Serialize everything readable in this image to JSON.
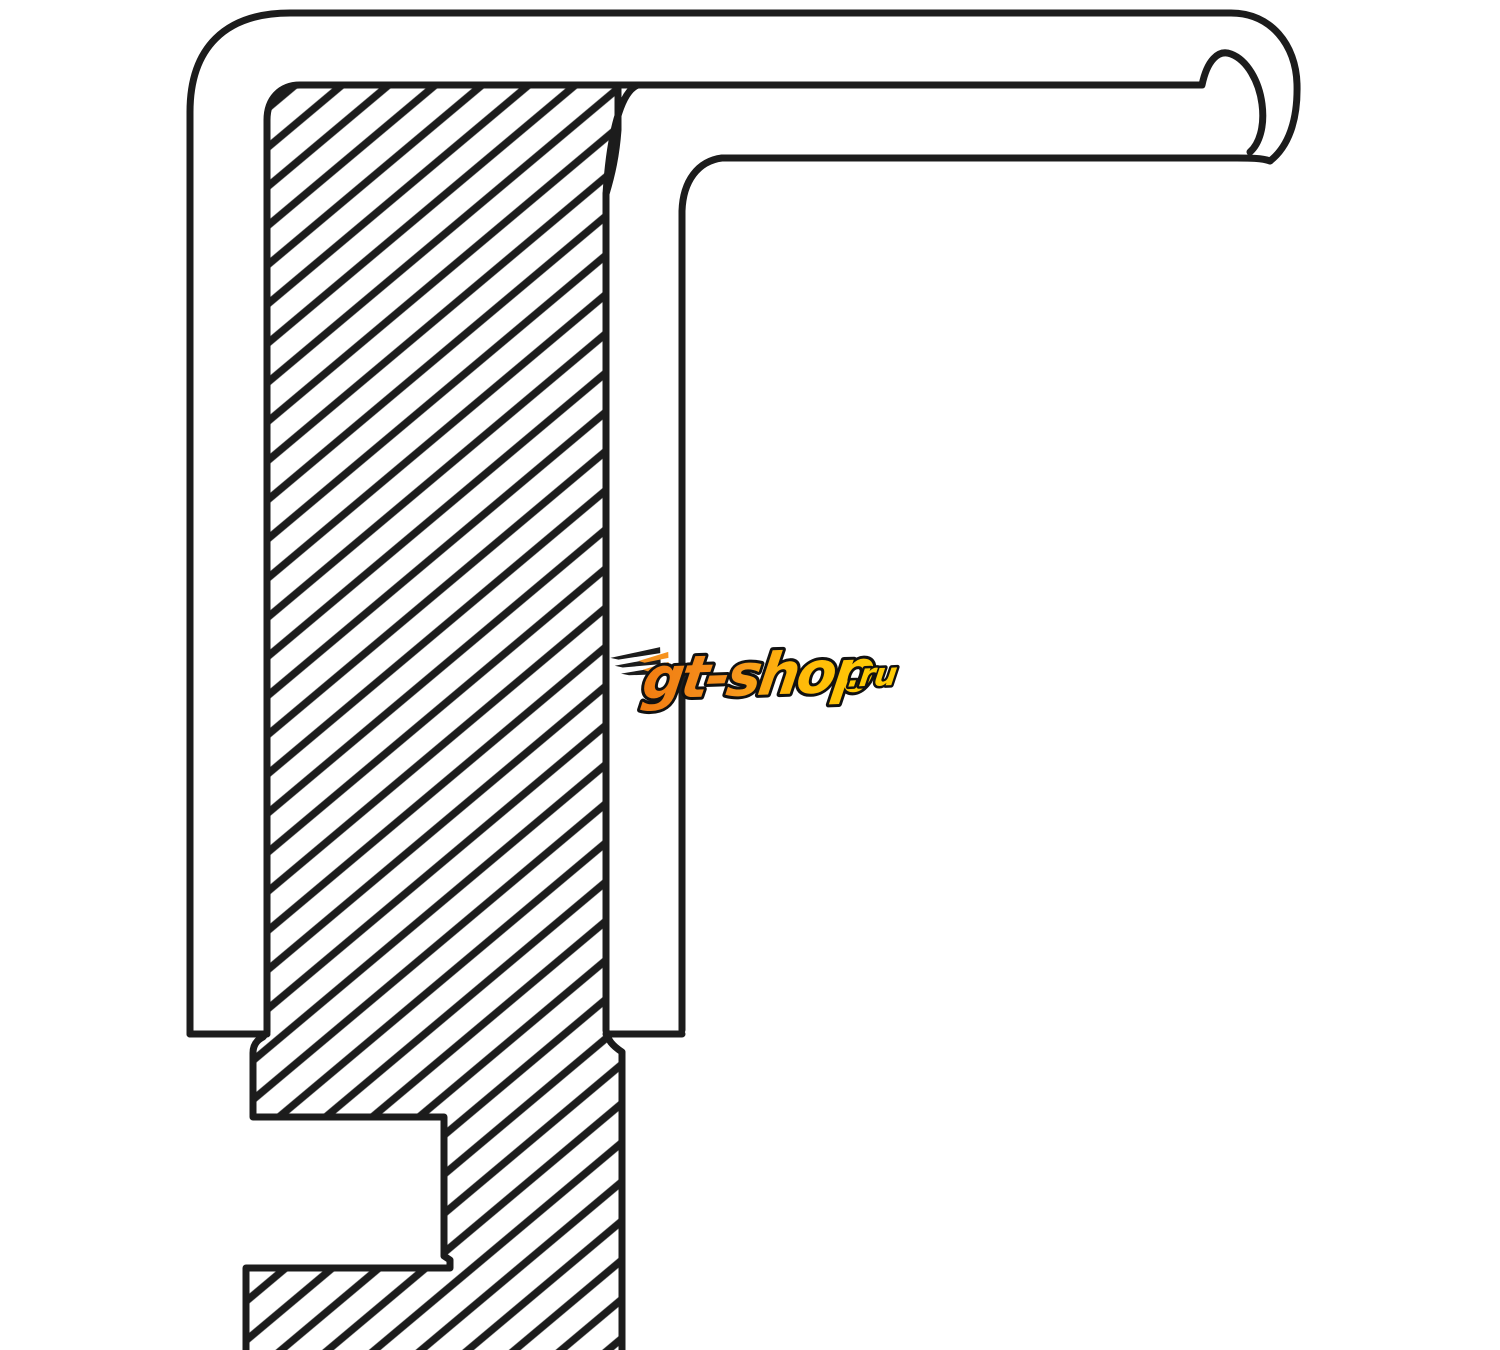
{
  "canvas": {
    "width_px": 1500,
    "height_px": 1350,
    "background_color": "#ffffff"
  },
  "diagram": {
    "subject": "seal-cross-section-technical-drawing",
    "line_color": "#1c1c1c",
    "fill_color": "#ffffff",
    "hatch": {
      "style": "diagonal-lines",
      "angle_deg": -40,
      "perpendicular_spacing_px": 30,
      "line_width_px": 7.5,
      "color": "#1c1c1c"
    }
  },
  "watermark": {
    "text_main": "gt-shop",
    "text_suffix": ".ru",
    "color_orange": "#F6921E",
    "color_orange_deep": "#F07C11",
    "color_gold": "#FFB60A",
    "color_yellow": "#FFCB05",
    "outline_color": "#111111"
  }
}
